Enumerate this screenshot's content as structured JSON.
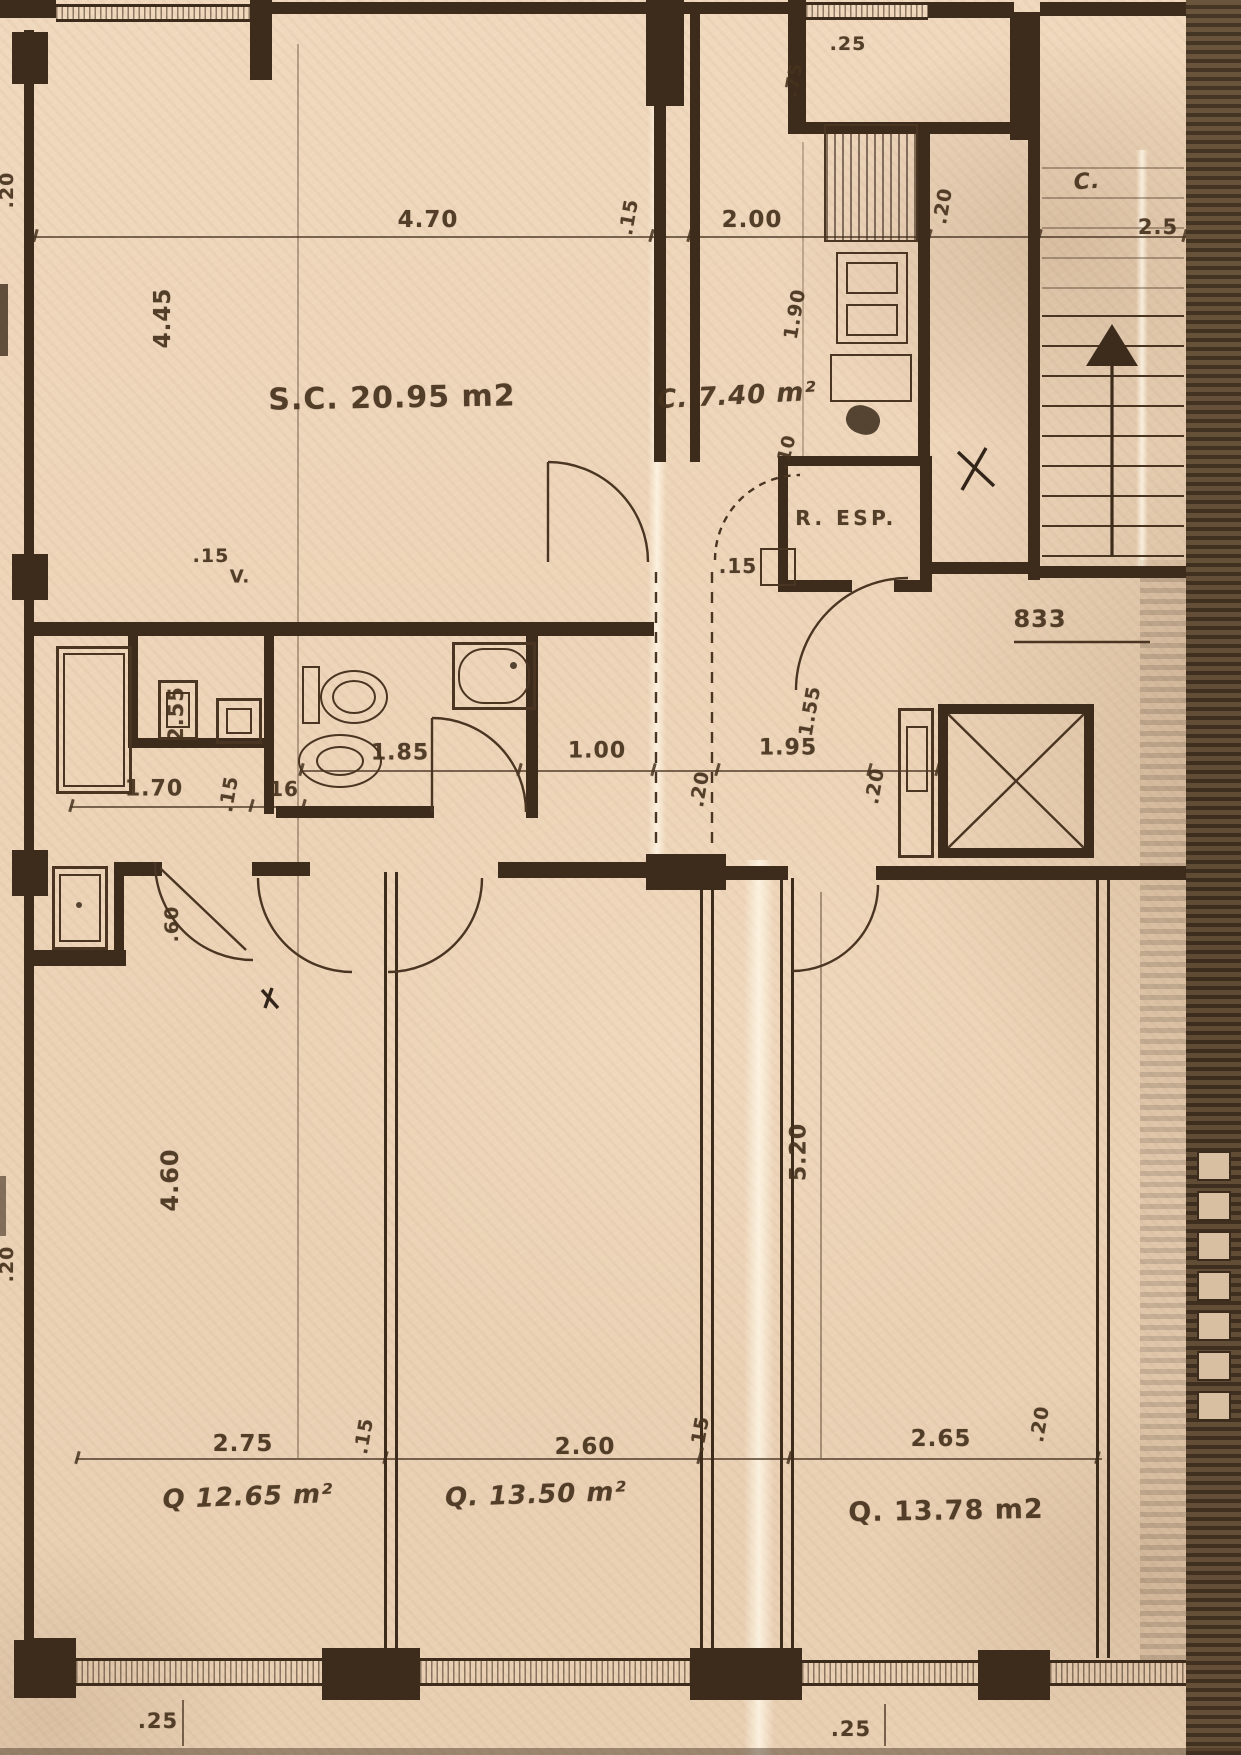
{
  "meta": {
    "drawing_type": "scanned apartment floor plan blueprint",
    "units": "meters",
    "paper_color": "#edd3b6",
    "ink_color": "#3d2c1c"
  },
  "rooms": [
    {
      "id": "room-living-label",
      "kind": "room",
      "text": "S.C. 20.95 m2"
    },
    {
      "id": "room-kitchen-label",
      "kind": "room",
      "text": "C. 7.40 m²"
    },
    {
      "id": "room-pantry-label",
      "kind": "room",
      "text": "R. ESP."
    },
    {
      "id": "room-stair-label",
      "kind": "room",
      "text": "C."
    },
    {
      "id": "room-bedroom1-label",
      "kind": "room",
      "text": "Q 12.65 m²"
    },
    {
      "id": "room-bedroom2-label",
      "kind": "room",
      "text": "Q. 13.50 m²"
    },
    {
      "id": "room-bedroom3-label",
      "kind": "room",
      "text": "Q. 13.78 m2"
    }
  ],
  "level_mark": "833",
  "annotations": [
    {
      "id": "dim-25-top",
      "text": ".25",
      "x": 848,
      "y": 44,
      "rot": 0,
      "size": 19
    },
    {
      "id": "dim-470",
      "text": "4.70",
      "x": 428,
      "y": 220,
      "rot": 0,
      "size": 23
    },
    {
      "id": "dim-15-top",
      "text": ".15",
      "x": 629,
      "y": 217,
      "rot": -80,
      "size": 19
    },
    {
      "id": "dim-200",
      "text": "2.00",
      "x": 752,
      "y": 220,
      "rot": 0,
      "size": 23
    },
    {
      "id": "dim-20-top",
      "text": ".20",
      "x": 943,
      "y": 206,
      "rot": -80,
      "size": 19
    },
    {
      "id": "dim-25-right",
      "text": "2.5",
      "x": 1158,
      "y": 227,
      "rot": 0,
      "size": 21
    },
    {
      "id": "room-stair-label",
      "text": "C.",
      "x": 1087,
      "y": 182,
      "rot": -4,
      "size": 22,
      "style": "italic"
    },
    {
      "id": "dim-75",
      "text": ".75",
      "x": 794,
      "y": 80,
      "rot": -80,
      "size": 18
    },
    {
      "id": "dim-445",
      "text": "4.45",
      "x": 163,
      "y": 318,
      "rot": -90,
      "size": 23
    },
    {
      "id": "room-living-label",
      "text": "S.C. 20.95 m2",
      "x": 392,
      "y": 398,
      "rot": -1,
      "size": 30
    },
    {
      "id": "room-kitchen-label",
      "text": "C. 7.40 m²",
      "x": 737,
      "y": 396,
      "rot": -3,
      "size": 26,
      "style": "italic"
    },
    {
      "id": "dim-190",
      "text": "1.90",
      "x": 795,
      "y": 314,
      "rot": -80,
      "size": 19
    },
    {
      "id": "dim-10",
      "text": ".10",
      "x": 786,
      "y": 452,
      "rot": -75,
      "size": 18
    },
    {
      "id": "room-pantry-label",
      "text": "R. ESP.",
      "x": 846,
      "y": 518,
      "rot": 0,
      "size": 20,
      "style": "ls3"
    },
    {
      "id": "dim-15-mid",
      "text": ".15",
      "x": 738,
      "y": 566,
      "rot": 0,
      "size": 20
    },
    {
      "id": "level-mark",
      "text": "833",
      "x": 1040,
      "y": 619,
      "rot": 0,
      "size": 24
    },
    {
      "id": "vent-label",
      "text": "V.",
      "x": 240,
      "y": 577,
      "rot": 0,
      "size": 18
    },
    {
      "id": "dim-15-bath",
      "text": ".15",
      "x": 211,
      "y": 556,
      "rot": 0,
      "size": 19
    },
    {
      "id": "dim-255",
      "text": "2.55",
      "x": 176,
      "y": 714,
      "rot": -90,
      "size": 21
    },
    {
      "id": "dim-185",
      "text": "1.85",
      "x": 400,
      "y": 753,
      "rot": 0,
      "size": 22
    },
    {
      "id": "dim-100",
      "text": "1.00",
      "x": 597,
      "y": 751,
      "rot": 0,
      "size": 22
    },
    {
      "id": "dim-195",
      "text": "1.95",
      "x": 788,
      "y": 748,
      "rot": 0,
      "size": 22
    },
    {
      "id": "dim-20-a",
      "text": ".20",
      "x": 700,
      "y": 789,
      "rot": -80,
      "size": 19
    },
    {
      "id": "dim-20-b",
      "text": ".20",
      "x": 875,
      "y": 786,
      "rot": -80,
      "size": 19
    },
    {
      "id": "dim-155",
      "text": "1.55",
      "x": 810,
      "y": 711,
      "rot": -80,
      "size": 19
    },
    {
      "id": "dim-170",
      "text": "1.70",
      "x": 154,
      "y": 789,
      "rot": 0,
      "size": 22
    },
    {
      "id": "dim-15-c",
      "text": ".15",
      "x": 229,
      "y": 794,
      "rot": -80,
      "size": 19
    },
    {
      "id": "dim-16",
      "text": "16",
      "x": 284,
      "y": 789,
      "rot": 0,
      "size": 20
    },
    {
      "id": "dim-60",
      "text": ".60",
      "x": 172,
      "y": 924,
      "rot": -90,
      "size": 19
    },
    {
      "id": "dim-20-left-top",
      "text": ".20",
      "x": 7,
      "y": 190,
      "rot": -90,
      "size": 19
    },
    {
      "id": "dim-20-left-bottom",
      "text": ".20",
      "x": 7,
      "y": 1264,
      "rot": -90,
      "size": 19
    },
    {
      "id": "dim-460",
      "text": "4.60",
      "x": 170,
      "y": 1180,
      "rot": -90,
      "size": 24
    },
    {
      "id": "dim-520",
      "text": "5.20",
      "x": 799,
      "y": 1152,
      "rot": -90,
      "size": 22
    },
    {
      "id": "dim-275",
      "text": "2.75",
      "x": 243,
      "y": 1444,
      "rot": 0,
      "size": 23
    },
    {
      "id": "dim-15-d",
      "text": ".15",
      "x": 364,
      "y": 1436,
      "rot": -80,
      "size": 19
    },
    {
      "id": "dim-260",
      "text": "2.60",
      "x": 585,
      "y": 1447,
      "rot": 0,
      "size": 23
    },
    {
      "id": "dim-15-e",
      "text": ".15",
      "x": 700,
      "y": 1434,
      "rot": -80,
      "size": 19
    },
    {
      "id": "dim-265",
      "text": "2.65",
      "x": 941,
      "y": 1439,
      "rot": 0,
      "size": 23
    },
    {
      "id": "dim-20-c",
      "text": ".20",
      "x": 1040,
      "y": 1424,
      "rot": -80,
      "size": 19
    },
    {
      "id": "room-bedroom1-label",
      "text": "Q 12.65 m²",
      "x": 248,
      "y": 1497,
      "rot": -2,
      "size": 26,
      "style": "italic"
    },
    {
      "id": "room-bedroom2-label",
      "text": "Q. 13.50 m²",
      "x": 536,
      "y": 1495,
      "rot": -2,
      "size": 26,
      "style": "italic"
    },
    {
      "id": "room-bedroom3-label",
      "text": "Q. 13.78 m2",
      "x": 946,
      "y": 1511,
      "rot": -1,
      "size": 27
    },
    {
      "id": "dim-25-bottom-left",
      "text": ".25",
      "x": 158,
      "y": 1721,
      "rot": 0,
      "size": 21
    },
    {
      "id": "dim-25-bottom-right",
      "text": ".25",
      "x": 851,
      "y": 1729,
      "rot": 0,
      "size": 21
    }
  ]
}
